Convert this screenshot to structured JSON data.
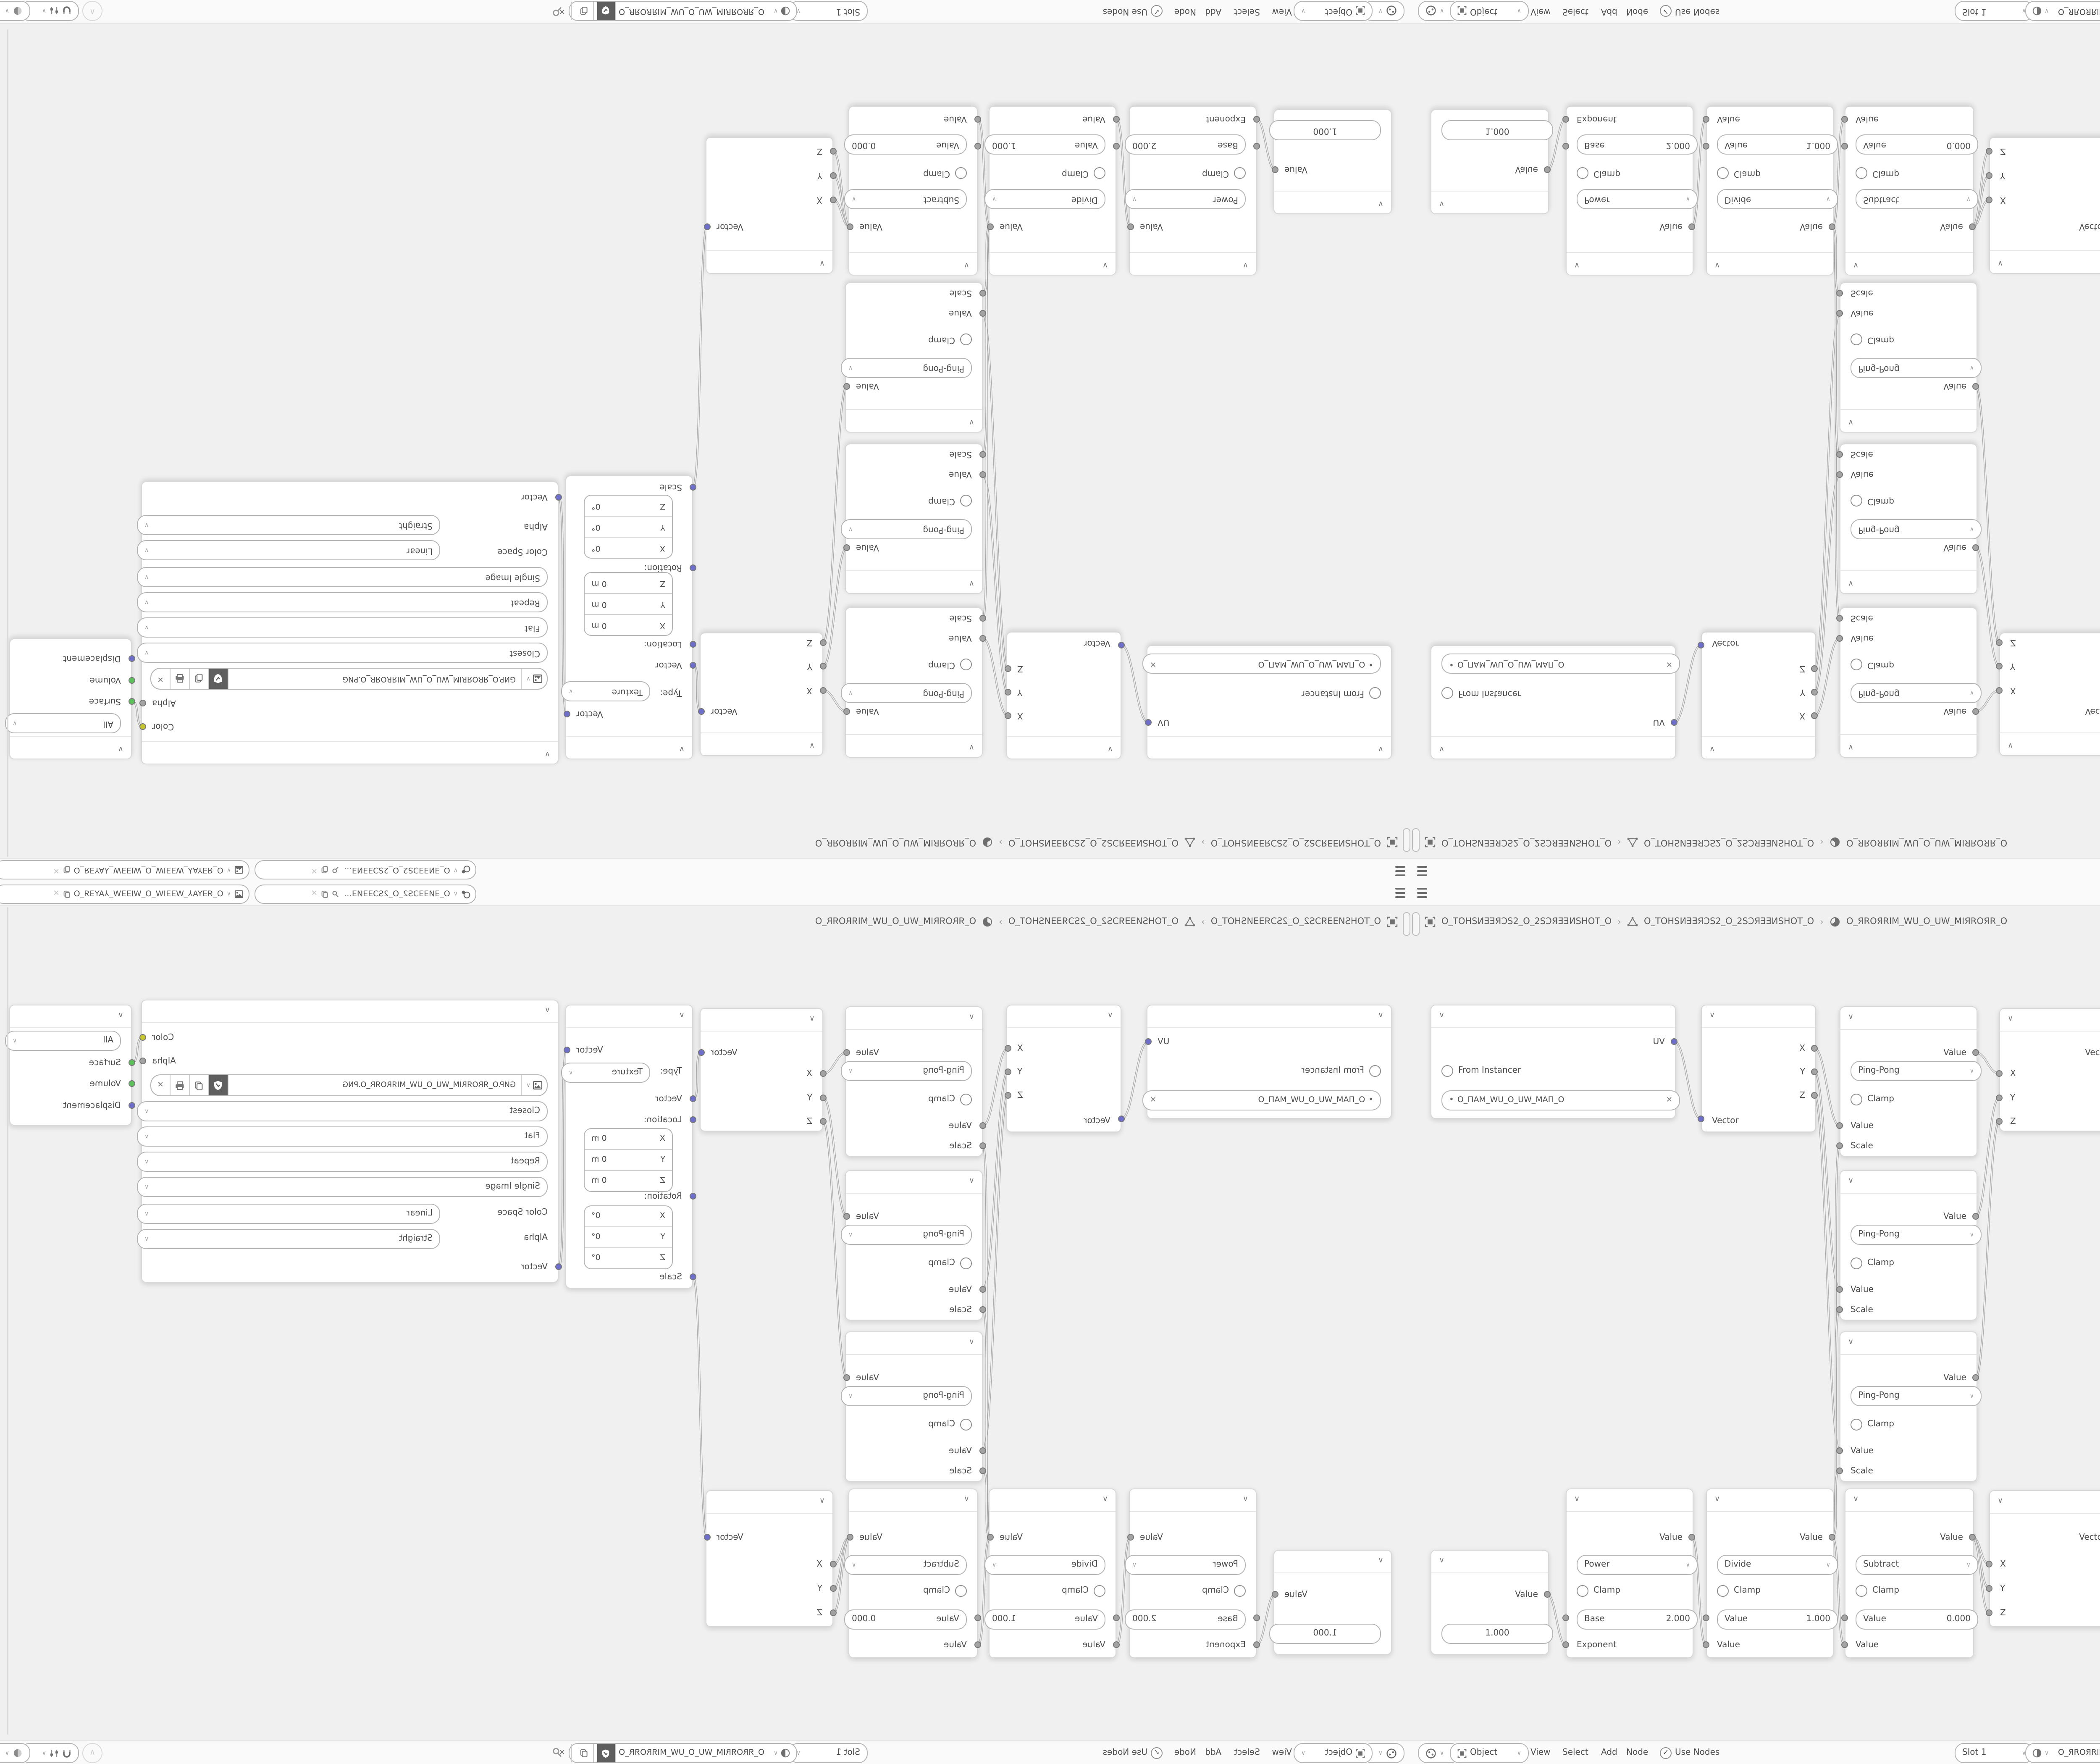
{
  "colors": {
    "canvas": "#f0f0f0",
    "bar_background": "#fafafa",
    "node_body": "#ffffff",
    "socket_value_gray": "#a3a3a3",
    "socket_vector_purple": "#6e6ecb",
    "socket_shader_green": "#5cc05c",
    "socket_color_yellow": "#c6c62e",
    "wire": "#a9a9a9"
  },
  "topbar": {
    "scene_name": "O_ƎͶƎƎƆS2_O_2SƆƎƎͶƎ_O",
    "viewlayer_name": "O_ЯƎYA⅄_WƎƎIW_O_WIƎƎW_⅄AYƎЯ_O"
  },
  "context_path": {
    "object_name": "O_TOHSИƎƎЯƆS2_O_2SƆЯƎƎИSHOT_O",
    "mesh_name": "O_TOHSИƎƎЯƆS2_O_2SƆЯƎƎИSHOT_O",
    "material_name": "O_ЯROЯRIM_WU_O_UW_MIЯROЯR_O",
    "separator": "›"
  },
  "editor_header": {
    "mode": "Object",
    "menus": [
      "View",
      "Select",
      "Add",
      "Node"
    ],
    "use_nodes_label": "Use Nodes",
    "slot_label": "Slot 1",
    "material_name": "O_ЯROЯRIM_WU_O_UW_MIЯROЯR_O"
  },
  "nodes": {
    "uv_map": {
      "output": "UV",
      "from_instancer": "From Instancer",
      "uv_name": "O_ПAM_WU_O_UW_MAП_O",
      "clear_icon": "✕"
    },
    "separate_xyz": {
      "out_x": "X",
      "out_y": "Y",
      "out_z": "Z",
      "input": "Vector"
    },
    "math_pingpong": {
      "output": "Value",
      "operation": "Ping-Pong",
      "clamp": "Clamp",
      "in_value": "Value",
      "in_scale": "Scale"
    },
    "combine_xyz": {
      "output": "Vector",
      "in_x": "X",
      "in_y": "Y",
      "in_z": "Z"
    },
    "mapping": {
      "output": "Vector",
      "type_label": "Type:",
      "type_value": "Texture",
      "in_vector": "Vector",
      "location_label": "Location:",
      "rotation_label": "Rotation:",
      "scale_label": "Scale",
      "location_rows": [
        [
          "X",
          "0 m"
        ],
        [
          "Y",
          "0 m"
        ],
        [
          "Z",
          "0 m"
        ]
      ],
      "rotation_rows": [
        [
          "X",
          "0°"
        ],
        [
          "Y",
          "0°"
        ],
        [
          "Z",
          "0°"
        ]
      ]
    },
    "image_texture": {
      "out_color": "Color",
      "out_alpha": "Alpha",
      "image_name": "GИP.O_ЯROЯRIM_WU_O_UW_MIЯROЯR_O.PNG",
      "interpolation": "Closest",
      "projection": "Flat",
      "extension": "Repeat",
      "source": "Single Image",
      "color_space_label": "Color Space",
      "color_space": "Linear",
      "alpha_label": "Alpha",
      "alpha_mode": "Straight",
      "in_vector": "Vector"
    },
    "material_output": {
      "target": "All",
      "in_surface": "Surface",
      "in_volume": "Volume",
      "in_displacement": "Displacement"
    },
    "value_node": {
      "output": "Value",
      "value": "1.000"
    },
    "power": {
      "output": "Value",
      "operation": "Power",
      "clamp": "Clamp",
      "field_label": "Base",
      "field_value": "2.000",
      "input": "Exponent"
    },
    "divide": {
      "output": "Value",
      "operation": "Divide",
      "clamp": "Clamp",
      "field_label": "Value",
      "field_value": "1.000",
      "input": "Value"
    },
    "subtract": {
      "output": "Value",
      "operation": "Subtract",
      "clamp": "Clamp",
      "field_label": "Value",
      "field_value": "0.000",
      "input": "Value"
    }
  },
  "links": [
    [
      "uv-out",
      "sep-in"
    ],
    [
      "sep-x",
      "pp1-val"
    ],
    [
      "sep-y",
      "pp2-val"
    ],
    [
      "sep-z",
      "pp3-val"
    ],
    [
      "pp1-out",
      "c1-x"
    ],
    [
      "pp2-out",
      "c1-y"
    ],
    [
      "pp3-out",
      "c1-z"
    ],
    [
      "c1-out",
      "map-in"
    ],
    [
      "map-out",
      "img-vec"
    ],
    [
      "img-color",
      "mo-surface"
    ],
    [
      "val-out",
      "pow-exp"
    ],
    [
      "pow-out",
      "div-in"
    ],
    [
      "div-out",
      "sub-in"
    ],
    [
      "div-out",
      "pp1-scale"
    ],
    [
      "div-out",
      "pp2-scale"
    ],
    [
      "div-out",
      "pp3-scale"
    ],
    [
      "sub-out",
      "c2-x"
    ],
    [
      "sub-out",
      "c2-y"
    ],
    [
      "sub-out",
      "c2-z"
    ],
    [
      "c2-out",
      "map-scale"
    ]
  ]
}
